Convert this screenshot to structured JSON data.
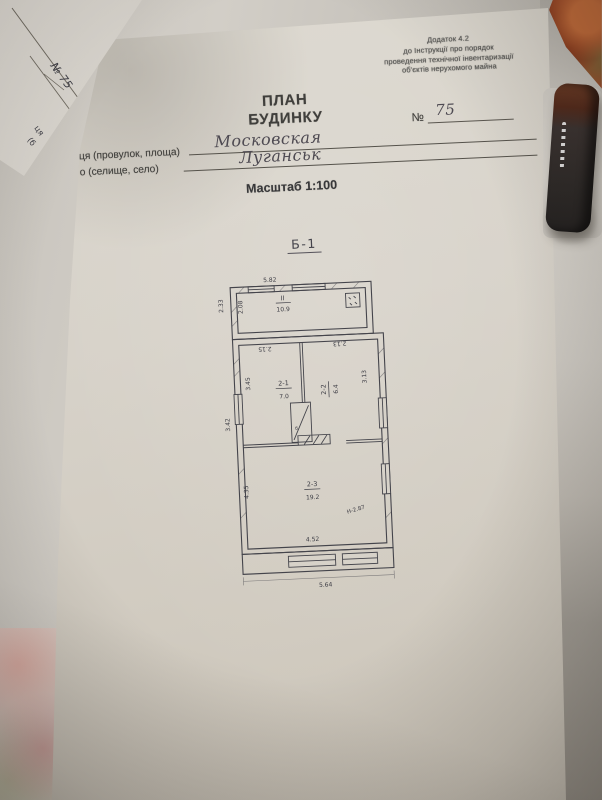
{
  "background": {
    "underlay_paper": {
      "number": "№ 75",
      "fragments": [
        "ця",
        "(б"
      ]
    }
  },
  "form": {
    "appendix": [
      "Додаток 4.2",
      "до Інструкції про порядок",
      "проведення технічної інвентаризації",
      "об'єктів нерухомого майна"
    ],
    "title_line1": "ПЛАН",
    "title_line2": "БУДИНКУ",
    "number_label": "№",
    "number_value": "75",
    "street_label": "ця (провулок, площа)",
    "street_value": "Московская",
    "city_label": "о (селище, село)",
    "city_value": "Луганськ",
    "scale_label": "Масштаб 1:100"
  },
  "plan": {
    "building_label": "Б-1",
    "veranda": {
      "room_no": "II",
      "area": "10.9",
      "dim_width": "5.82",
      "dim_left_outer": "2.33",
      "dim_left_inner": "2.08"
    },
    "room1": {
      "no": "2-1",
      "area": "7.0",
      "dim_top": "2.15",
      "dim_side": "3.45"
    },
    "room2": {
      "no": "2-2",
      "area": "6.4",
      "dim_top": "2.13",
      "dim_side": "3.13"
    },
    "room3": {
      "no": "2-3",
      "area": "19.2",
      "dim_side": "4.35"
    },
    "closet_mark": "б",
    "dim_left_wall": "3.42",
    "dim_bottom_inner": "4.52",
    "dim_bottom_outer": "5.64",
    "height_note": "Н-2.87"
  },
  "colors": {
    "ink": "#3c3c44",
    "paper": "#d8d3ca",
    "cloth": "#bdb9b1",
    "fabric_orange": "#a0492a"
  }
}
